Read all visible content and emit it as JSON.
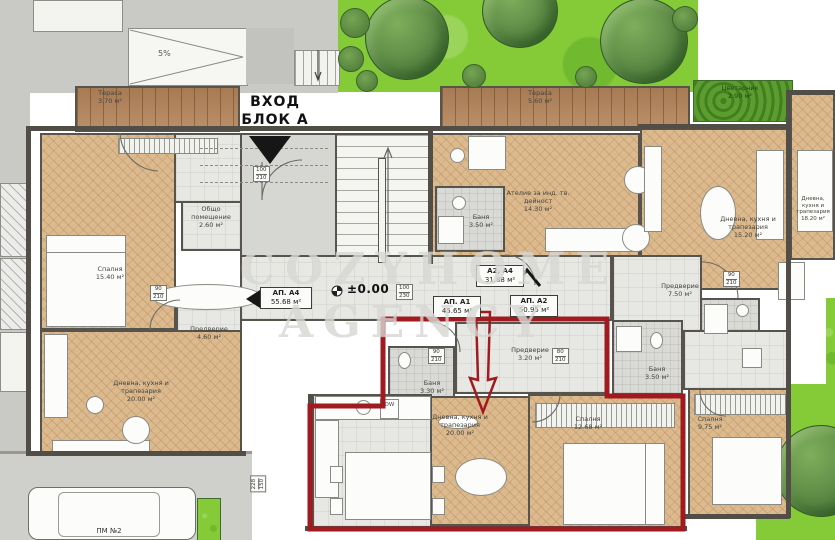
{
  "watermark": {
    "line1": "COZYHOME",
    "line2": "AGENCY"
  },
  "entrance": {
    "line1": "ВХОД",
    "line2": "БЛОК А"
  },
  "level_marker": "±0.00",
  "ramp_label": "5%",
  "parking": {
    "label": "ПМ №2"
  },
  "kitchen": {
    "dw": "DW"
  },
  "apartments": [
    {
      "name": "АП. А4",
      "area": "55.68 м²"
    },
    {
      "name": "АП. А1",
      "area": "45.65 м²"
    },
    {
      "name": "АП. А2",
      "area": "50.95 м²"
    },
    {
      "name": "А2, А4",
      "area": "31.88 м²"
    }
  ],
  "rooms": [
    {
      "label": "Тераса",
      "area": "3.70 м²"
    },
    {
      "label": "Тераса",
      "area": "5.60 м²"
    },
    {
      "label": "Цветарник",
      "area": "2.90 м²"
    },
    {
      "label": "Спалня",
      "area": "15.40 м²"
    },
    {
      "label": "Общо помещение",
      "area": "2.60 м²"
    },
    {
      "label": "Предверие",
      "area": "4.60 м²"
    },
    {
      "label": "Дневна, кухня и трапезария",
      "area": "20.00 м²"
    },
    {
      "label": "Ателие за инд. тв. дейност",
      "area": "14.30 м²"
    },
    {
      "label": "Баня",
      "area": "3.50 м²"
    },
    {
      "label": "Дневна, кухня и трапезария",
      "area": "15.20 м²"
    },
    {
      "label": "Предверие",
      "area": "7.50 м²"
    },
    {
      "label": "Предверие",
      "area": "3.20 м²"
    },
    {
      "label": "Баня",
      "area": "3.30 м²"
    },
    {
      "label": "Дневна, кухня и трапезария",
      "area": "20.00 м²"
    },
    {
      "label": "Баня",
      "area": "3.50 м²"
    },
    {
      "label": "Спалня",
      "area": "12.68 м²"
    },
    {
      "label": "Спалня",
      "area": "9.75 м²"
    },
    {
      "label": "Дневна, кухня и трапезария",
      "area": "18.20 м²"
    }
  ],
  "door_dims": [
    {
      "w": "100",
      "h": "210"
    },
    {
      "w": "100",
      "h": "230"
    },
    {
      "w": "90",
      "h": "210"
    },
    {
      "w": "90",
      "h": "210"
    },
    {
      "w": "80",
      "h": "210"
    },
    {
      "w": "90",
      "h": "210"
    },
    {
      "w": "228",
      "h": "150"
    }
  ],
  "colors": {
    "highlight_red": "#a01a20",
    "garden_green": "#85ca37",
    "wood": "#dcba8e",
    "deck": "#b5855a"
  }
}
